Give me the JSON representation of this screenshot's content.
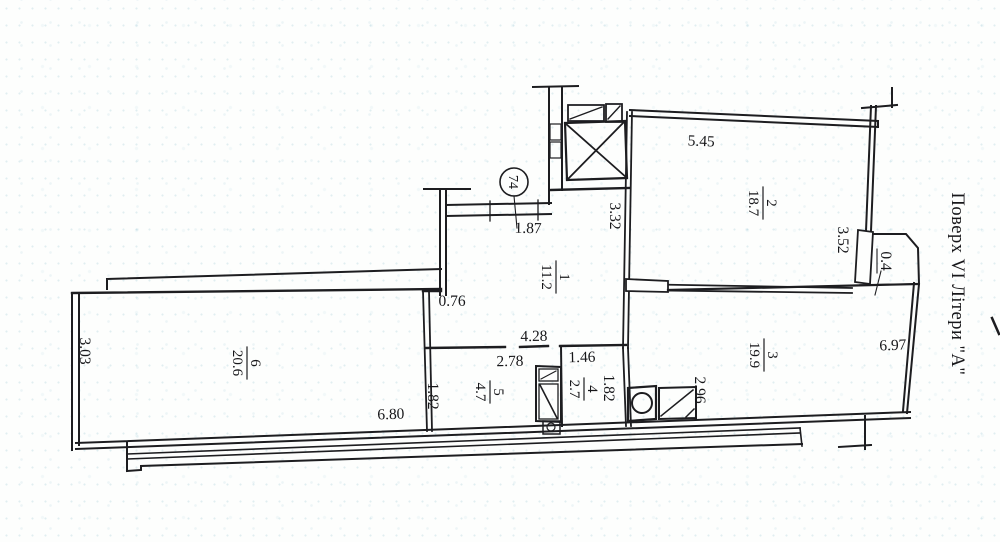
{
  "plan": {
    "side_label": "Поверх VI Літери \"А\"",
    "apartment_number": "74"
  },
  "rooms": {
    "r1": {
      "number": "1",
      "area": "11.2"
    },
    "r2": {
      "number": "2",
      "area": "18.7"
    },
    "r3": {
      "number": "3",
      "area": "19.9"
    },
    "r4": {
      "number": "4",
      "area": "2.7"
    },
    "r5": {
      "number": "5",
      "area": "4.7"
    },
    "r6": {
      "number": "6",
      "area": "20.6"
    }
  },
  "dims": {
    "entry_door": "1.87",
    "hall_depth": "3.32",
    "room2_width": "5.45",
    "room2_depth": "3.52",
    "small_balcony": "0.4",
    "room3_width": "6.97",
    "room3_left": "2.96",
    "niche": "0.76",
    "corridor_run": "4.28",
    "room5_width": "2.78",
    "room5_depth": "1.82",
    "room4_width": "1.46",
    "room4_depth": "1.82",
    "room6_depth": "3.03",
    "room6_width": "6.80"
  }
}
